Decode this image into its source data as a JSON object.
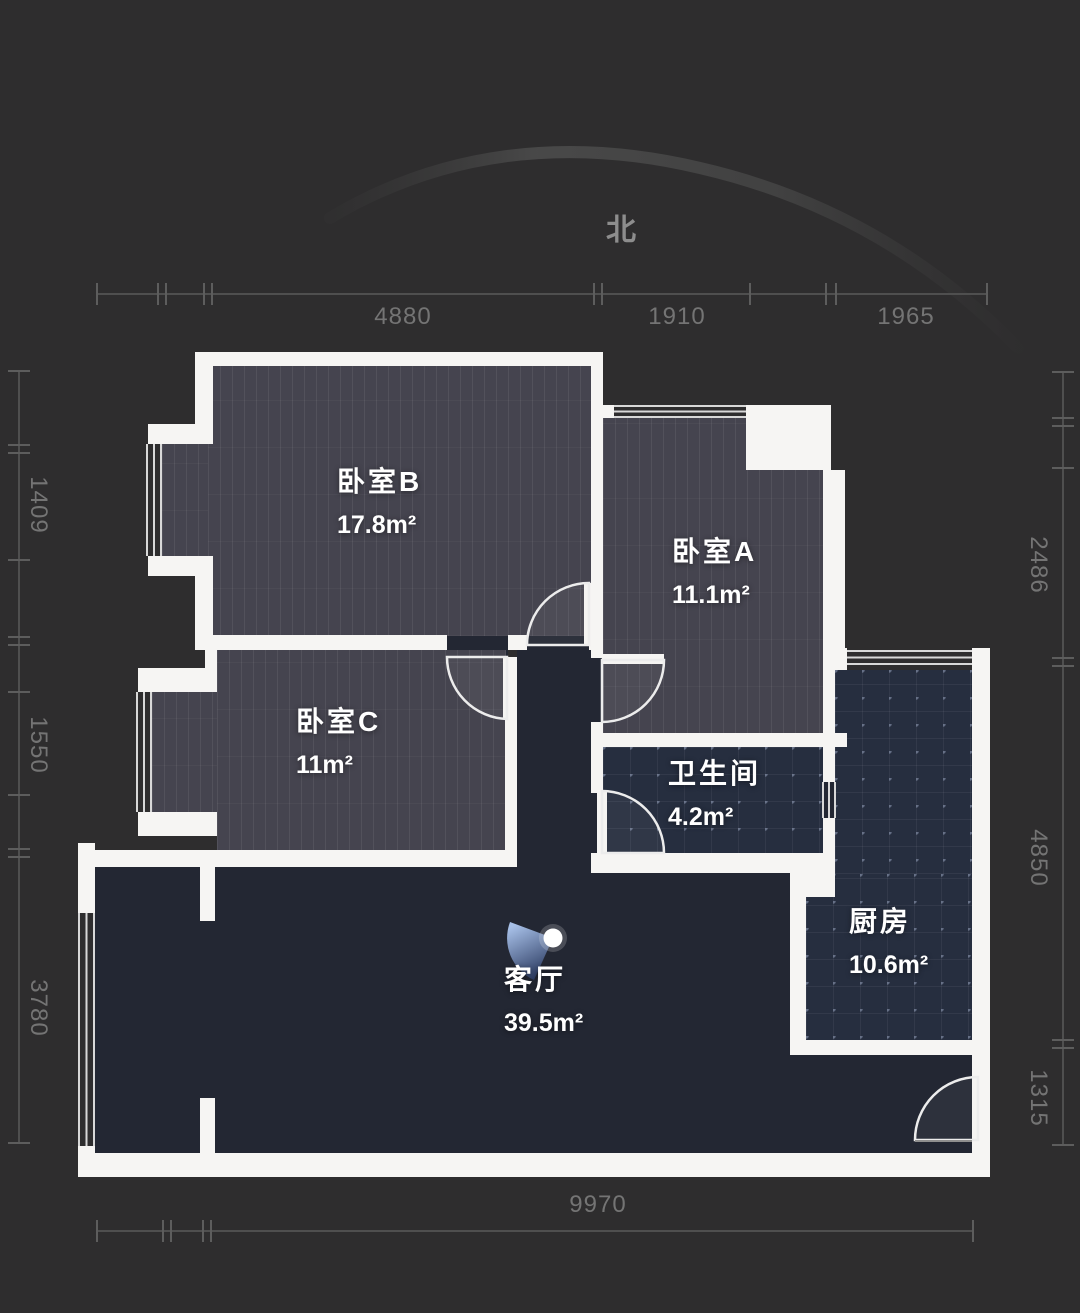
{
  "compass": {
    "north_label": "北"
  },
  "rooms": {
    "bedroom_b": {
      "name": "卧室B",
      "area": "17.8m²"
    },
    "bedroom_a": {
      "name": "卧室A",
      "area": "11.1m²"
    },
    "bedroom_c": {
      "name": "卧室C",
      "area": "11m²"
    },
    "bathroom": {
      "name": "卫生间",
      "area": "4.2m²"
    },
    "kitchen": {
      "name": "厨房",
      "area": "10.6m²"
    },
    "living_room": {
      "name": "客厅",
      "area": "39.5m²"
    }
  },
  "dimensions": {
    "top": [
      "4880",
      "1910",
      "1965"
    ],
    "left": [
      "1409",
      "1550",
      "3780"
    ],
    "right": [
      "2486",
      "4850",
      "1315"
    ],
    "bottom": [
      "9970"
    ]
  },
  "colors": {
    "background": "#2e2d2e",
    "wall": "#f6f5f3",
    "floor_wood": "#45444f",
    "floor_dark": "#232733",
    "floor_tile": "#262e3f",
    "ruler": "#747474",
    "camera_accent": "#7fa0d4"
  }
}
